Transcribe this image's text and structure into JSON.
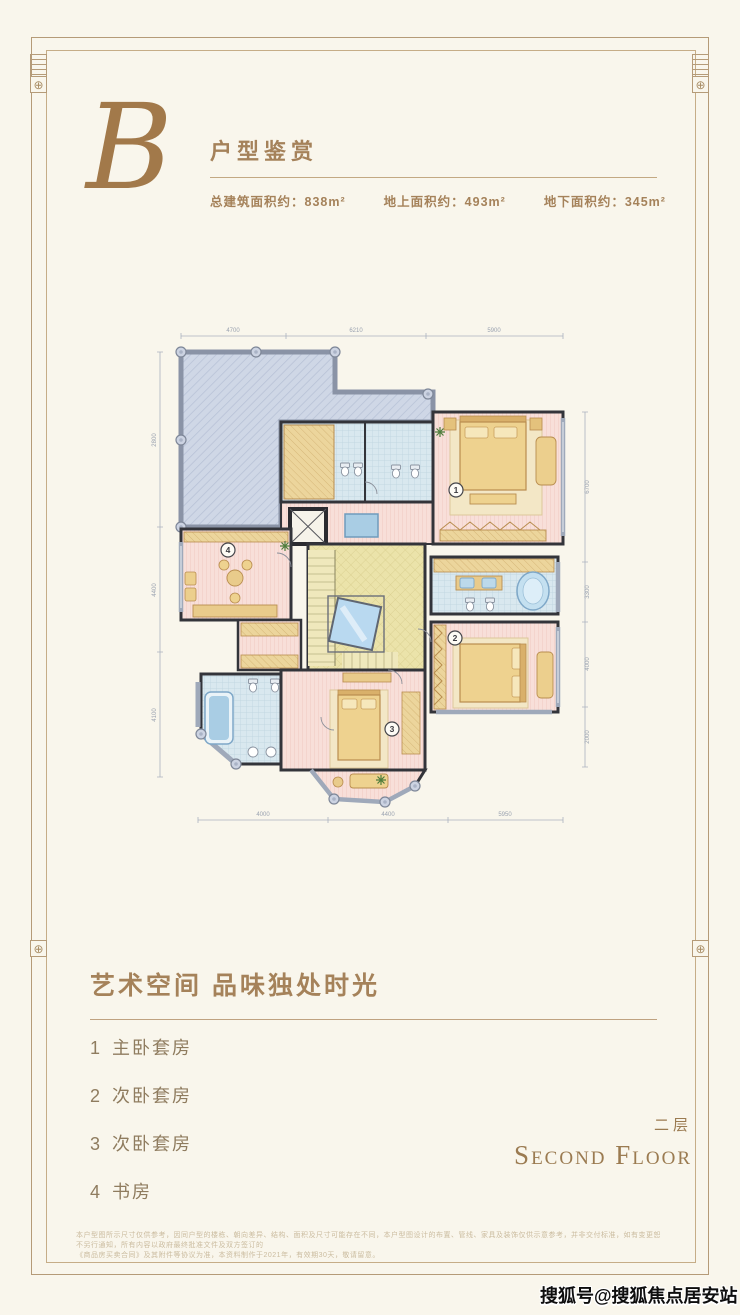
{
  "header": {
    "monogram": "B",
    "title": "户型鉴赏",
    "stats": [
      {
        "label": "总建筑面积约：",
        "value": "838m²"
      },
      {
        "label": "地上面积约：",
        "value": "493m²"
      },
      {
        "label": "地下面积约：",
        "value": "345m²"
      }
    ]
  },
  "plan": {
    "dims": {
      "top": [
        "4700",
        "6210",
        "5900"
      ],
      "left": [
        "2800",
        "4400",
        "4100"
      ],
      "right": [
        "6700",
        "3300",
        "4000",
        "2000"
      ],
      "bottom": [
        "4000",
        "4400",
        "5950"
      ]
    }
  },
  "section": {
    "heading": "艺术空间 品味独处时光",
    "legend": [
      {
        "num": "1",
        "label": "主卧套房"
      },
      {
        "num": "2",
        "label": "次卧套房"
      },
      {
        "num": "3",
        "label": "次卧套房"
      },
      {
        "num": "4",
        "label": "书房"
      }
    ],
    "floor_cn": "二层",
    "floor_en": "Second Floor"
  },
  "footer": {
    "line1": "本户型图所示尺寸仅供参考，因同户型的楼栋、朝向差异、结构、面积及尺寸可能存在不同，本户型图设计的布置、管线、家具及装饰仅供示意参考，并非交付标准，如有变更恕不另行通知，所有内容以政府最终批准文件及双方签订的",
    "line2": "《商品房买卖合同》及其附件等协议为准，本资料制作于2021年，有效期30天，敬请留意。"
  },
  "watermark": "搜狐号@搜狐焦点居安站",
  "colors": {
    "accent": "#a5825a",
    "frame": "#b59b78"
  }
}
